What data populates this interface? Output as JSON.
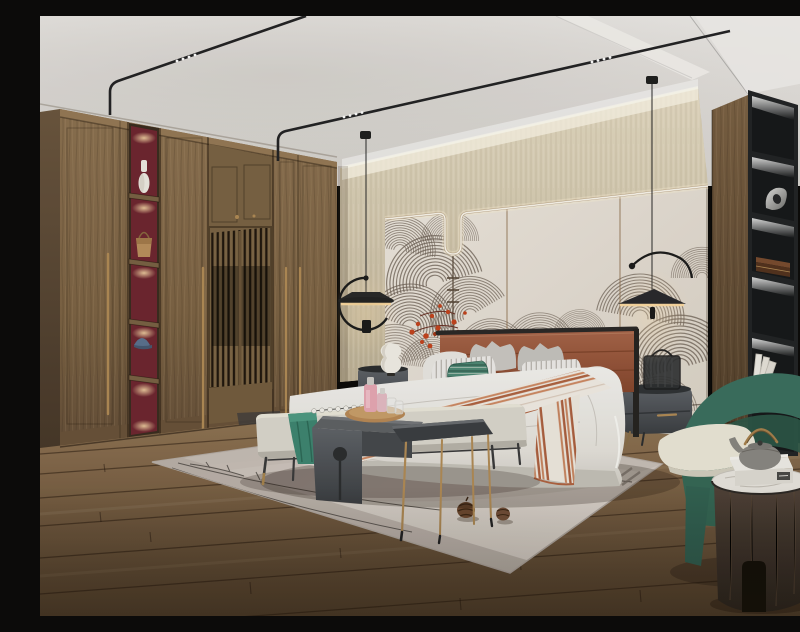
{
  "scene": {
    "type": "3d-interior-render",
    "room_label": "modern-wood-bedroom",
    "description": "Photorealistic rendering of a modern Chinese-style bedroom: wood wardrobe with lattice doors and lit display niches, beige headboard wall with wave mural panels and LED contour light, upholstered bed with striped runner, black pendant lamps, dark nightstands, bench with tray, green armchair, round wood side table with teapot, black display shelf, area rug with pine cones on a plank wood floor",
    "objects": [
      {
        "name": "ceiling-track-lights"
      },
      {
        "name": "cove-light"
      },
      {
        "name": "wallpaper-band"
      },
      {
        "name": "mural-panels"
      },
      {
        "name": "led-contour-light"
      },
      {
        "name": "blossom-branch"
      },
      {
        "name": "wardrobe"
      },
      {
        "name": "display-niches"
      },
      {
        "name": "lattice-doors"
      },
      {
        "name": "vase"
      },
      {
        "name": "handbag"
      },
      {
        "name": "cap"
      },
      {
        "name": "pendant-lamp-left"
      },
      {
        "name": "pendant-lamp-right"
      },
      {
        "name": "bed"
      },
      {
        "name": "headboard"
      },
      {
        "name": "pillows"
      },
      {
        "name": "striped-runner"
      },
      {
        "name": "bench"
      },
      {
        "name": "teal-throw"
      },
      {
        "name": "wood-tray"
      },
      {
        "name": "perfume-bottles"
      },
      {
        "name": "c-shaped-table"
      },
      {
        "name": "brass-leg-table"
      },
      {
        "name": "nightstand-left"
      },
      {
        "name": "table-lamp"
      },
      {
        "name": "nightstand-right"
      },
      {
        "name": "luggage-sculpture"
      },
      {
        "name": "black-bookshelf"
      },
      {
        "name": "metal-sculpture"
      },
      {
        "name": "wooden-box"
      },
      {
        "name": "white-books"
      },
      {
        "name": "armchair"
      },
      {
        "name": "seat-cushion"
      },
      {
        "name": "round-side-table"
      },
      {
        "name": "teapot"
      },
      {
        "name": "gift-box"
      },
      {
        "name": "area-rug"
      },
      {
        "name": "pine-cones"
      },
      {
        "name": "wood-floor"
      }
    ]
  },
  "palette": {
    "ceiling_base": "#e8e5e2",
    "ceiling_shadow": "#cfcac4",
    "ceiling_bright": "#f6f4f1",
    "wall_beige": "#d6ccb4",
    "panel_cream": "#eae4db",
    "panel_seam": "#8f6f50",
    "led_glow": "#fff3d6",
    "glow": "#ffdca2",
    "brass": "#b28c57",
    "art_line": "#6e6156",
    "blossom": "#c4441e",
    "wood_mid": "#85694a",
    "wood_dark": "#5c4933",
    "red_niche": "#6f2631",
    "floor_mid": "#7c6347",
    "rug_light": "#d8d0c9",
    "rug_dark": "#c5bcb5",
    "rug_line": "#413c38",
    "bed_white": "#f1efe9",
    "bed_base": "#d6d2cb",
    "terracotta": "#9c5a3c",
    "terracotta_dark": "#7c4229",
    "teal_deep": "#3f8672",
    "chair_teal": "#3b7060",
    "chair_teal_dark": "#2d5a4a",
    "cushion": "#ece8da",
    "furn_gray": "#55585c",
    "furn_gray_dark": "#3e4144",
    "metal_black": "#232325",
    "shelf_black": "#222426",
    "niche_dark": "#17191b",
    "marble": "#e9e6e0",
    "teapot": "#8b8884",
    "box_white": "#f1efe9",
    "lamp_white": "#f3f0e8",
    "pink": "#e8a9b6"
  }
}
